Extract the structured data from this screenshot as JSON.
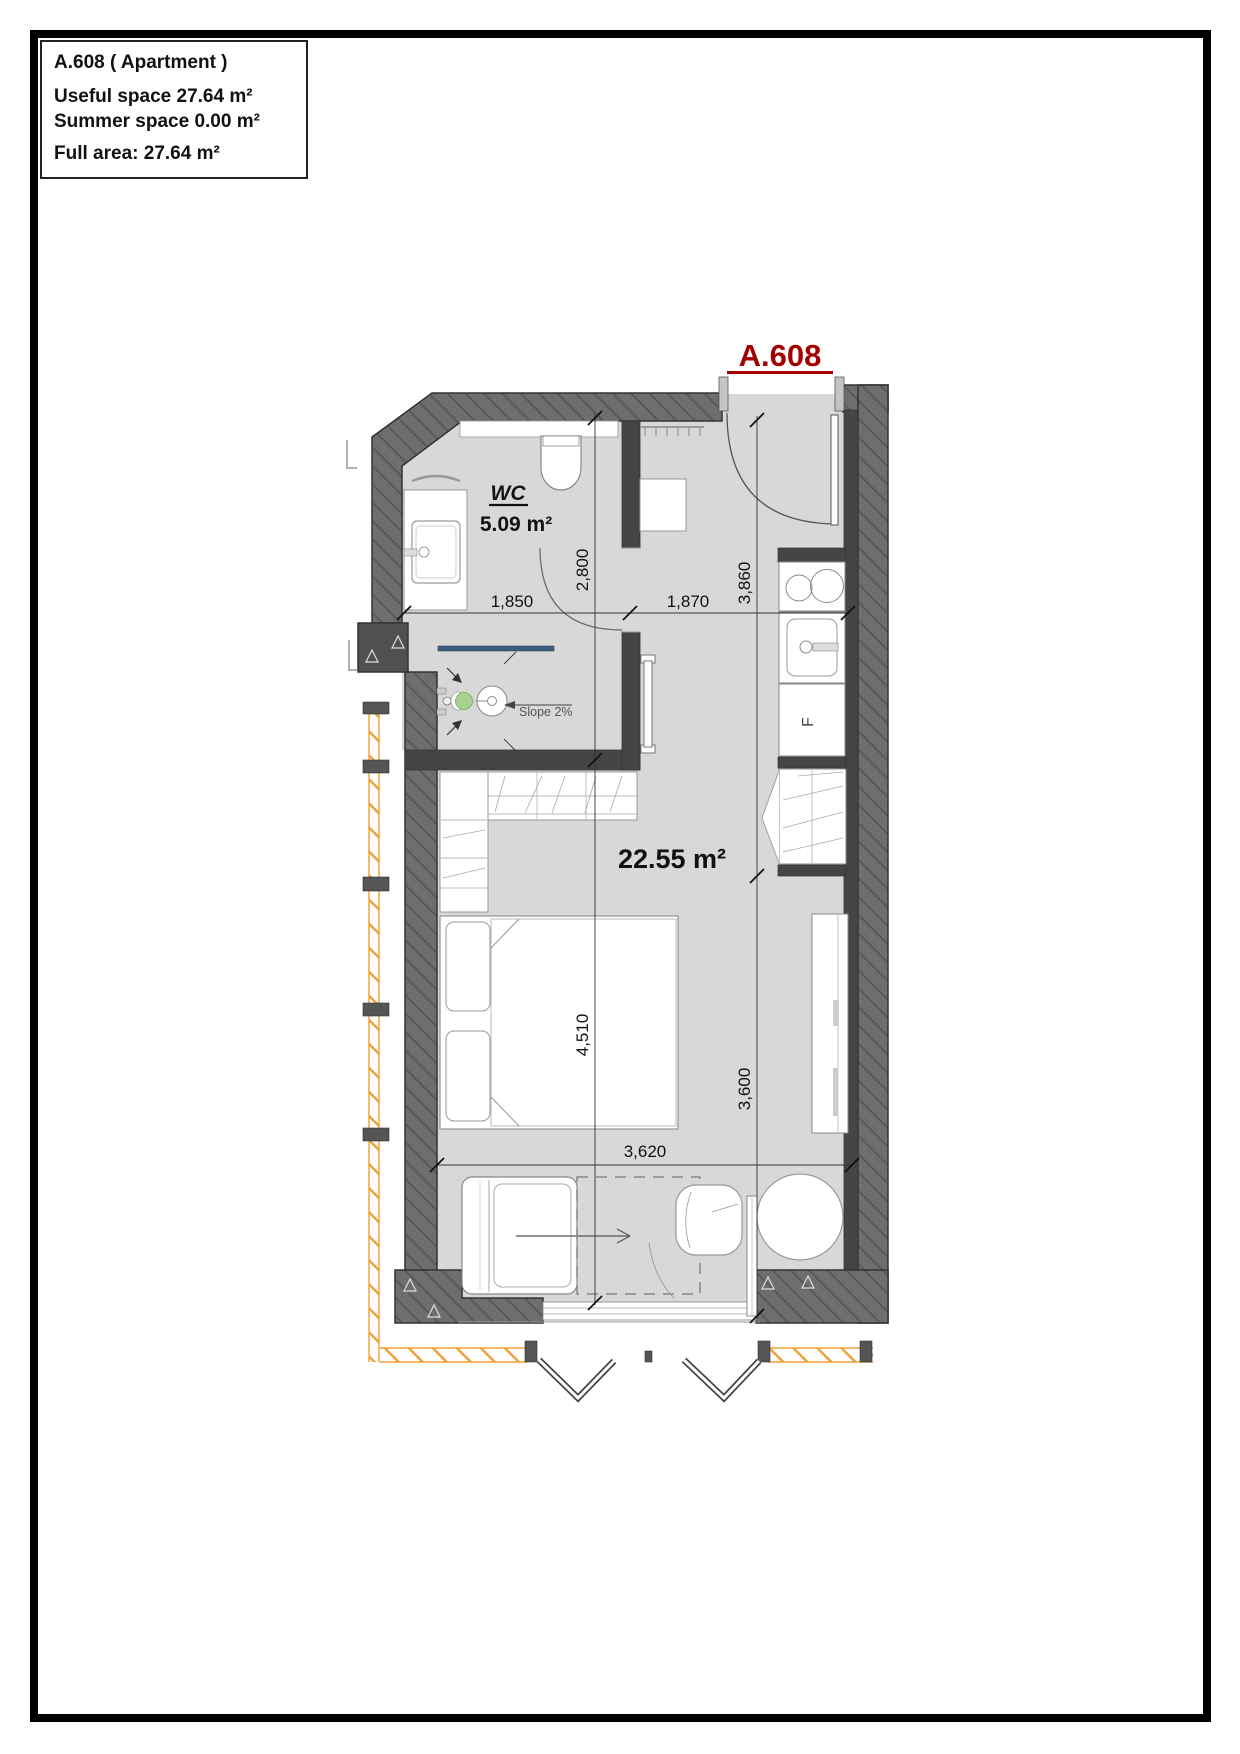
{
  "info_box": {
    "title": "A.608 ( Apartment )",
    "useful_space": "Useful space 27.64 m²",
    "summer_space": "Summer space 0.00 m²",
    "full_area": "Full area: 27.64 m²"
  },
  "plan": {
    "unit_label": "A.608",
    "rooms": {
      "wc": {
        "name": "WC",
        "area": "5.09 m²"
      },
      "main": {
        "area": "22.55 m²"
      }
    },
    "annotations": {
      "slope": "Slope 2%",
      "fridge": "F"
    },
    "dimensions": {
      "wc_width": "1,850",
      "hall_width": "1,870",
      "wc_depth": "2,800",
      "entry_depth": "3,860",
      "room_depth": "4,510",
      "room_right_depth": "3,600",
      "room_width": "3,620"
    },
    "colors": {
      "wall_hatch": "#6e6e6e",
      "wall_dark": "#454545",
      "floor": "#d8d8d8",
      "unit_label_red": "#a30000",
      "balcony_orange": "#ef9f35",
      "shower_glass": "#3d5d80",
      "drain_green": "#a9d18e"
    }
  }
}
